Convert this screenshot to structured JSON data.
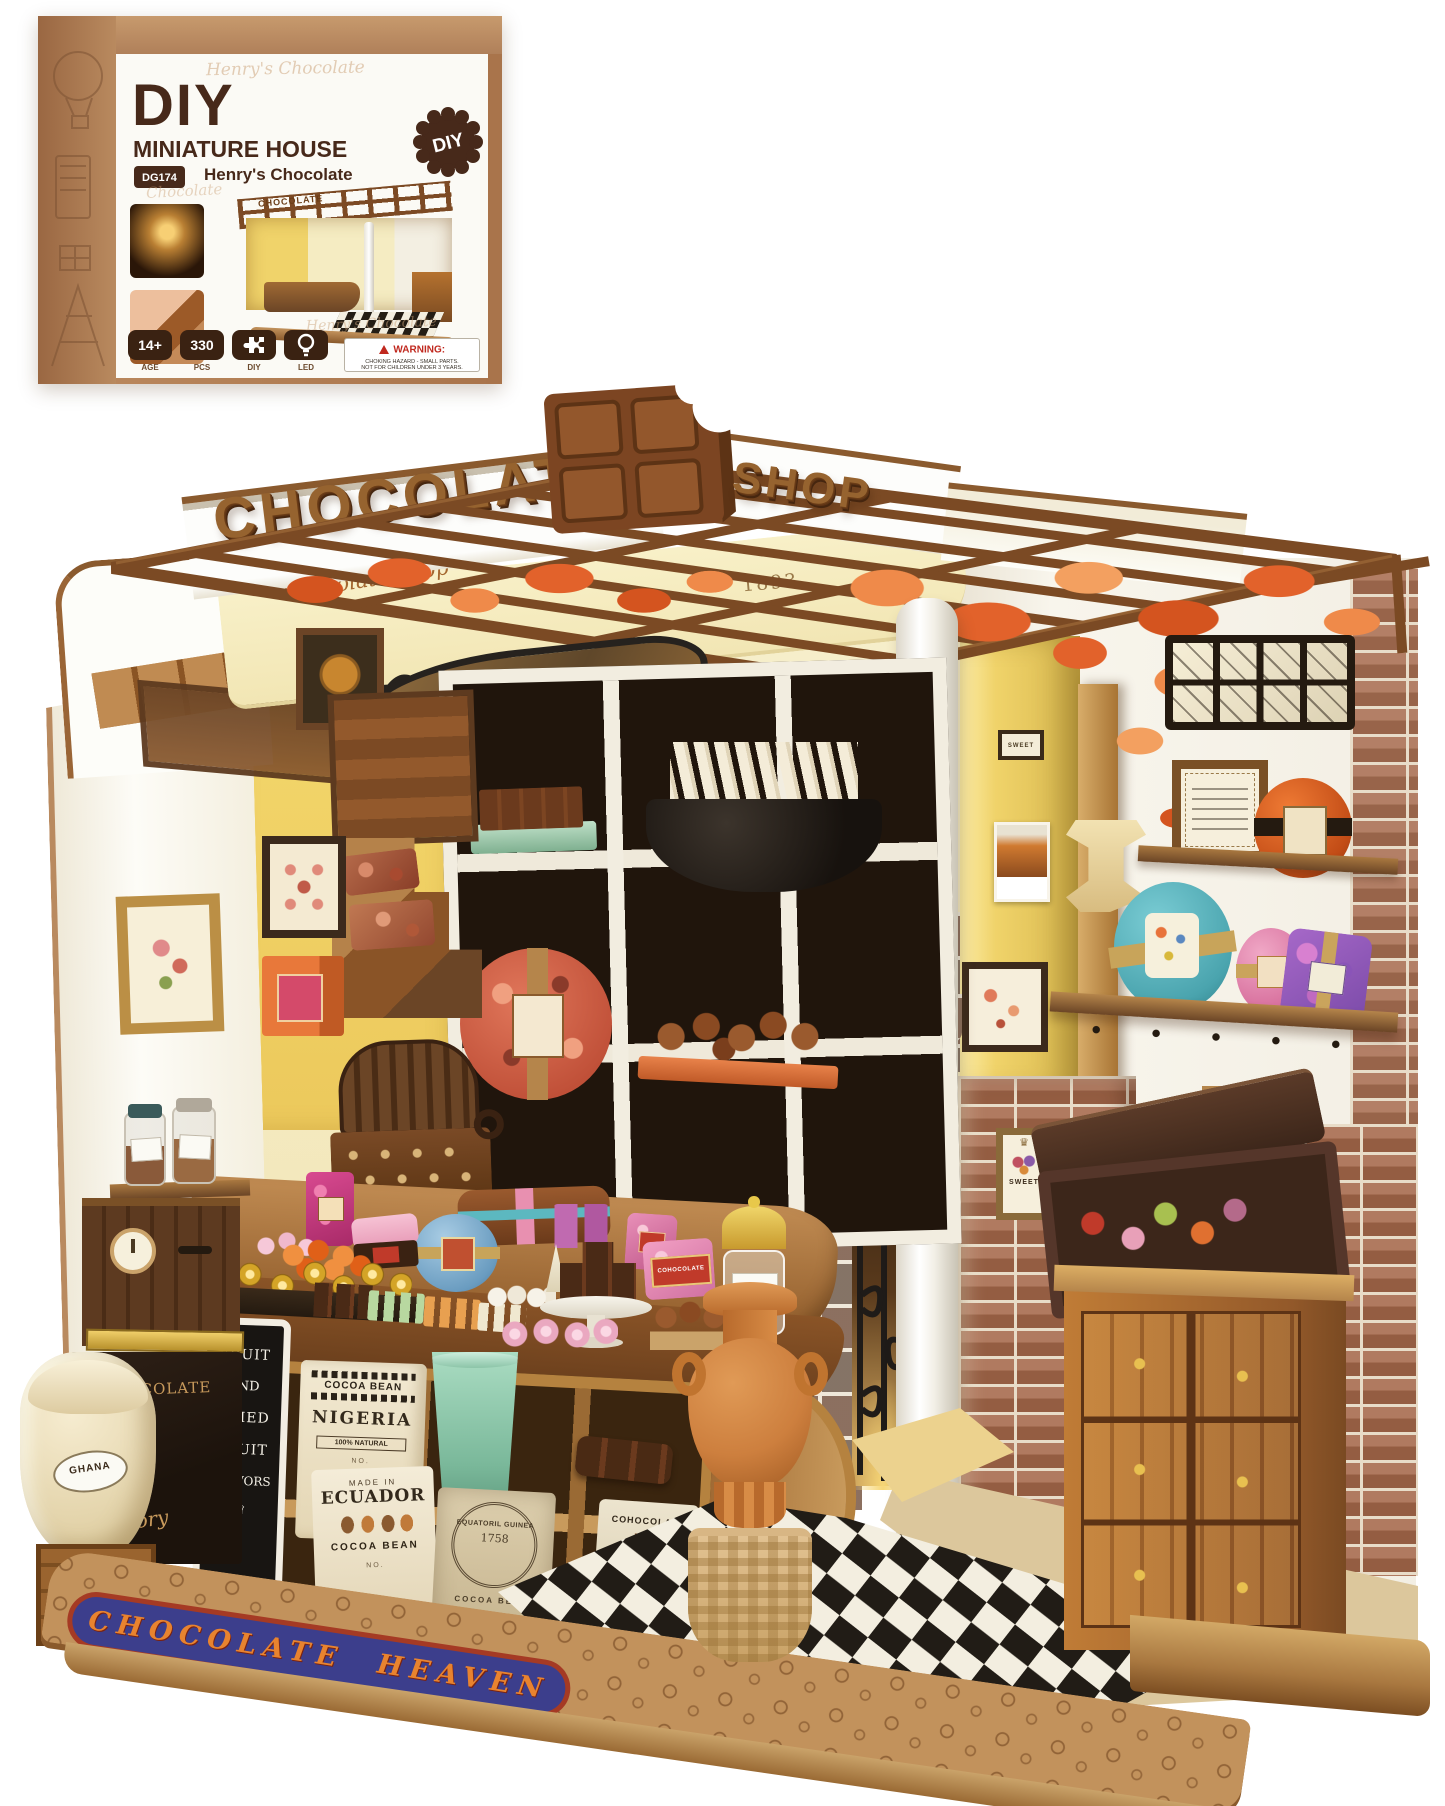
{
  "box": {
    "watermark_top": "Henry's  Chocolate",
    "watermark_mid": "Chocolate",
    "watermark_bottom": "Henry's  Chocolate",
    "title": "DIY",
    "subtitle": "MINIATURE HOUSE",
    "model_code": "DG174",
    "product_name": "Henry's Chocolate",
    "diy_badge": "DIY",
    "mini_sign": "CHOCOLATE",
    "badges": [
      {
        "value": "14+",
        "label": "AGE"
      },
      {
        "value": "330",
        "label": "PCS"
      },
      {
        "value": "",
        "label": "DIY"
      },
      {
        "value": "",
        "label": "LED"
      }
    ],
    "warning": {
      "title": "WARNING:",
      "line1": "CHOKING HAZARD - SMALL PARTS.",
      "line2": "NOT FOR CHILDREN UNDER 3 YEARS."
    }
  },
  "model": {
    "roof_sign_left": "CHOCOLATE",
    "roof_sign_right": "SHOP",
    "fascia_script": "Chocolate Shop",
    "fascia_year": "1893",
    "hanging_sign_left": "CHOCOLATE",
    "hanging_sign_right": "WORKSHOP",
    "base_banner": "CHOCOLATE HEAVEN",
    "sweet_sign": "SWEET",
    "chalkboard": {
      "l1": "FRUIT",
      "l2": "AND",
      "l3": "DRIED",
      "l4": "FRUIT",
      "l5": "FLAVORS"
    },
    "crate_title": "CHOCOLATE",
    "crate_script": "Factory",
    "ghana_label": "GHANA",
    "nigeria_sack": {
      "header": "COCOA BEAN",
      "name": "NIGERIA",
      "tag": "100% NATURAL",
      "no": "NO."
    },
    "ecuador_sack": {
      "header": "MADE IN",
      "name": "ECUADOR",
      "sub": "COCOA BEAN",
      "no": "NO."
    },
    "guinea_sack": {
      "stamp_top": "EQUATORIL GUINEA",
      "year": "1758",
      "sub": "COCOA BEAN"
    },
    "cohocolate_sack": {
      "name": "COHOCOLATE",
      "no": "NO.041"
    },
    "pink_bar_label": "COHOCOLATE"
  },
  "icons": {
    "crown": "♛",
    "heart": "♥"
  },
  "colors": {
    "kraft": "#b9895e",
    "dark_brown": "#452a16",
    "banner_blue": "#3c3e8c",
    "banner_orange": "#e8832f",
    "leaf_orange": "#e2622b",
    "teal": "#58b6bf",
    "terracotta": "#cd7f3e",
    "cream_wall": "#f5ecc2"
  }
}
